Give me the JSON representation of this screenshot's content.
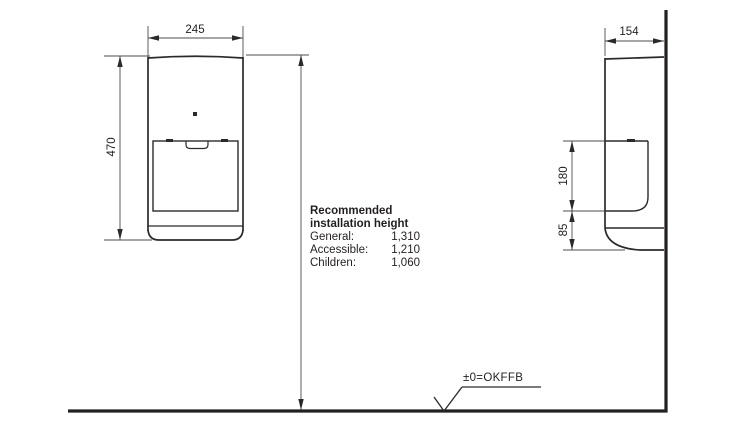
{
  "drawing": {
    "front_view": {
      "width_dim": "245",
      "height_dim": "470"
    },
    "side_view": {
      "depth_dim": "154",
      "opening_dim": "180",
      "base_dim": "85"
    },
    "datum": {
      "label": "±0=OKFFB"
    },
    "note": {
      "title_line1": "Recommended",
      "title_line2": "installation height",
      "rows": [
        {
          "label": "General:",
          "value": "1,310"
        },
        {
          "label": "Accessible:",
          "value": "1,210"
        },
        {
          "label": "Children:",
          "value": "1,060"
        }
      ]
    },
    "colors": {
      "outline": "#2b2a29",
      "dimension_line": "#4c4c4c",
      "background": "#ffffff"
    }
  }
}
